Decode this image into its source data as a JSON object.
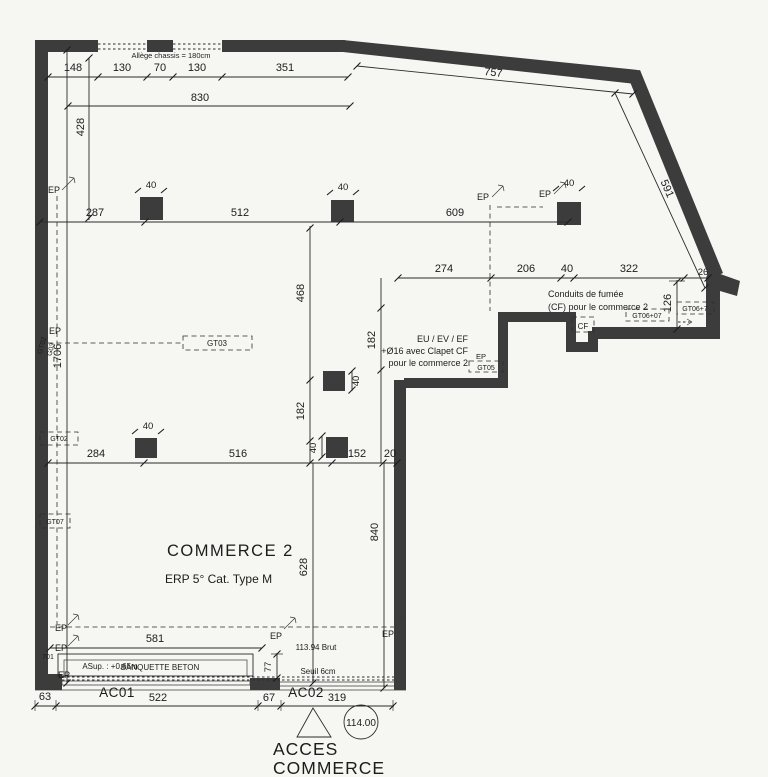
{
  "drawing": {
    "title": "COMMERCE 2",
    "subtitle": "ERP 5° Cat. Type M",
    "annotations": {
      "allege": "Allège chassis = 180cm",
      "conduits_line1": "Conduits de fumée",
      "conduits_line2": "(CF) pour le commerce 2",
      "evac_line1": "EU / EV / EF",
      "evac_line2": "+Ø16 avec Clapet CF",
      "evac_line3": "pour le commerce 2",
      "asup": "ASup. : +0.65m",
      "banquette": "BANQUETTE BETON",
      "brut": "113.94 Brut",
      "seuil": "Seuil 6cm",
      "level": "114.00",
      "access_line1": "ACCES",
      "access_line2": "COMMERCE"
    },
    "doors": {
      "ac01": "AC01",
      "ac02": "AC02"
    },
    "ducts": {
      "ep": "EP",
      "cf": "CF",
      "gt02": "GT02",
      "gt03": "GT03",
      "gt05": "GT05",
      "gt06_07": "GT06+07",
      "gt06_7": "GT06+7",
      "gt07": "GT07",
      "g01": "701",
      "gt02_small": "GT02",
      "g03_small": "G03"
    },
    "dims": {
      "d148": "148",
      "d130a": "130",
      "d70": "70",
      "d130b": "130",
      "d351": "351",
      "d830": "830",
      "d428": "428",
      "d757": "757",
      "d591": "591",
      "d287": "287",
      "d512": "512",
      "d609": "609",
      "d274": "274",
      "d206": "206",
      "d40r": "40",
      "d322": "322",
      "d26": "26",
      "d126": "126",
      "d468": "468",
      "d182r": "182",
      "d182l": "182",
      "d284": "284",
      "d516": "516",
      "d152": "152",
      "d20": "20",
      "d628": "628",
      "d840": "840",
      "d1706": "1706",
      "d581": "581",
      "d77": "77",
      "d63": "63",
      "d522": "522",
      "d67": "67",
      "d319": "319",
      "d40c1": "40",
      "d40c2": "40",
      "d40c3": "40",
      "d40c4": "40",
      "d40c5": "40",
      "d40c6": "40"
    },
    "colors": {
      "wall": "#3c3c3c",
      "line": "#2b2b2b",
      "background": "#f6f6f3"
    }
  }
}
